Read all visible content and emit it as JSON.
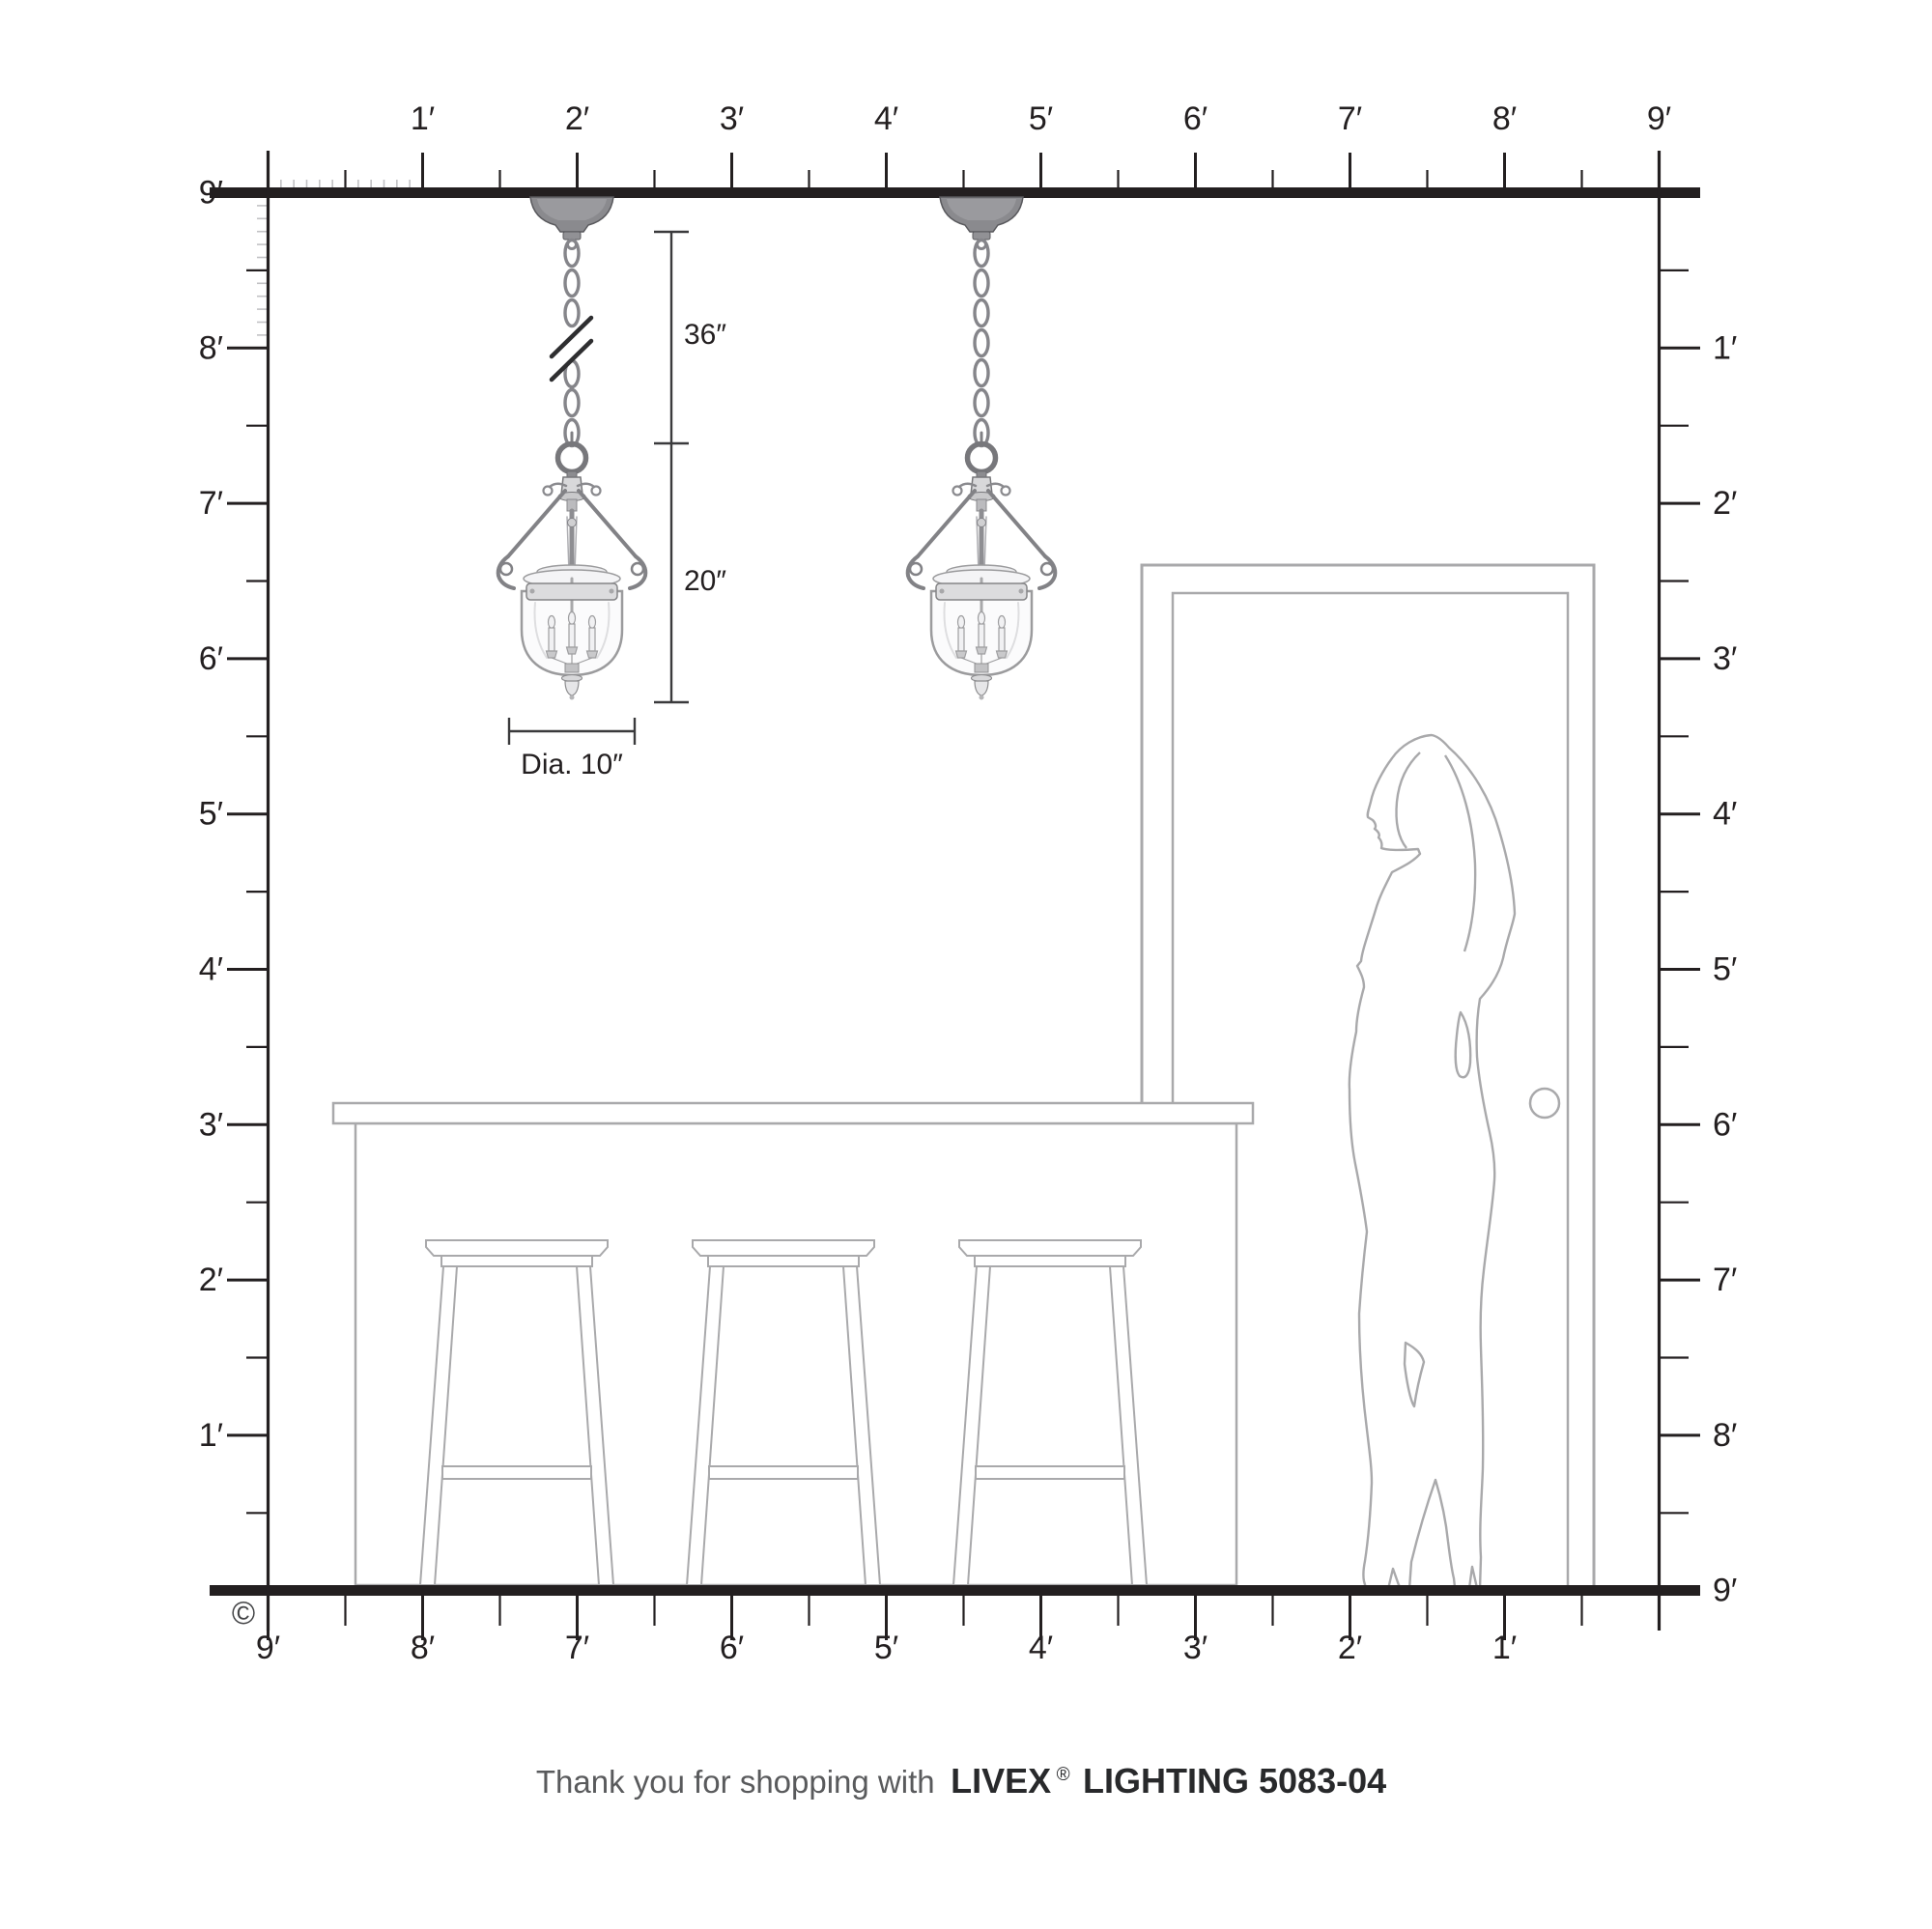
{
  "rulers": {
    "top": [
      "1′",
      "2′",
      "3′",
      "4′",
      "5′",
      "6′",
      "7′",
      "8′",
      "9′"
    ],
    "left": [
      "9′",
      "8′",
      "7′",
      "6′",
      "5′",
      "4′",
      "3′",
      "2′",
      "1′"
    ],
    "right": [
      "1′",
      "2′",
      "3′",
      "4′",
      "5′",
      "6′",
      "7′",
      "8′",
      "9′"
    ],
    "bottom": [
      "9′",
      "8′",
      "7′",
      "6′",
      "5′",
      "4′",
      "3′",
      "2′",
      "1′"
    ]
  },
  "dimensions": {
    "chain_length": "36″",
    "fixture_height": "20″",
    "fixture_diameter": "Dia. 10″"
  },
  "footer": {
    "prefix": "Thank you for shopping with",
    "brand": "LIVEX",
    "registered": "®",
    "suffix": "LIGHTING 5083-04"
  },
  "copyright": "©",
  "colors": {
    "ink": "#231f20",
    "scene_gray": "#a9a9ab",
    "inch_tick_gray": "#c2c2c4",
    "metal_gray": "#87878b"
  }
}
